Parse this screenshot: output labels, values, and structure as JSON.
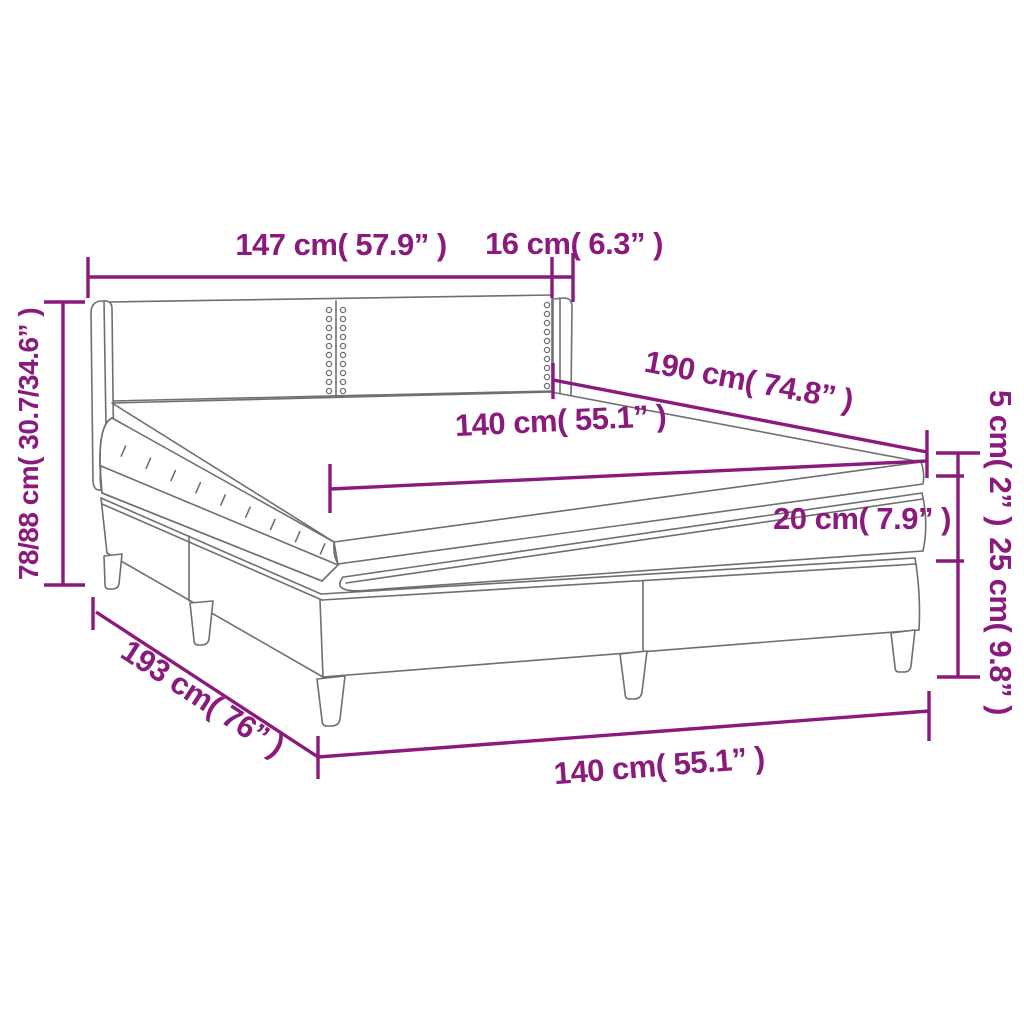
{
  "labels": {
    "headboard_width": "147 cm( 57.9” )",
    "wing_width": "16 cm( 6.3” )",
    "height_range": "78/88 cm( 30.7/34.6” )",
    "length": "190 cm( 74.8” )",
    "mattress_width": "140 cm( 55.1” )",
    "topper_height": "5 cm( 2” )",
    "mattress_height": "20 cm( 7.9” )",
    "base_height": "25 cm( 9.8” )",
    "base_length": "193 cm( 76” )",
    "base_width": "140 cm( 55.1” )"
  },
  "colors": {
    "dimension": "#8a1a7c",
    "drawing": "#6f6f6f",
    "background": "#ffffff"
  }
}
